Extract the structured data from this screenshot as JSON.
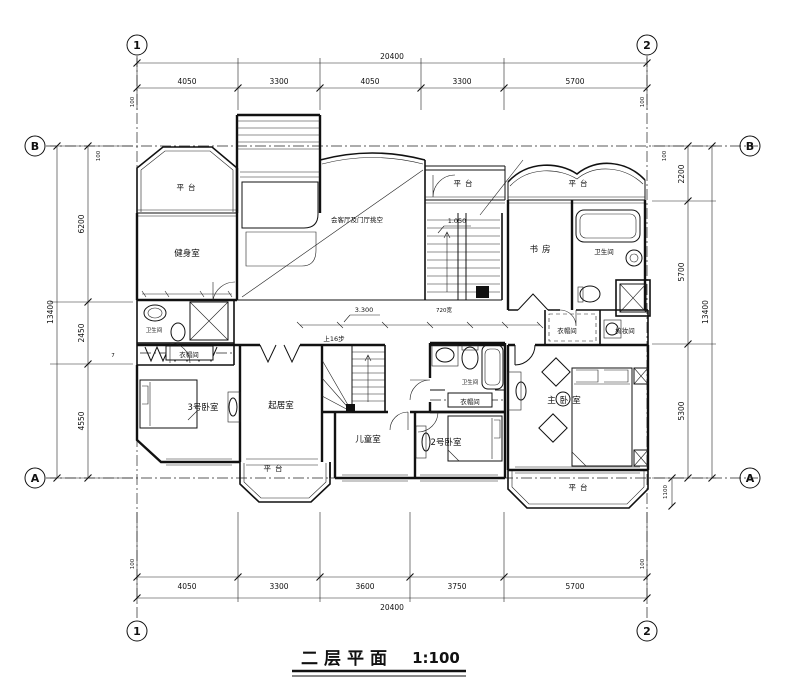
{
  "title": {
    "text": "二层平面",
    "scale": "1:100"
  },
  "axes": {
    "col_left": "1",
    "col_right": "2",
    "row_top": "B",
    "row_bottom": "A"
  },
  "dimensions": {
    "top": {
      "total": "20400",
      "seg1": "4050",
      "seg2": "3300",
      "seg3": "4050",
      "seg4": "3300",
      "seg5": "5700",
      "off_left": "100",
      "off_right": "100"
    },
    "bottom": {
      "total": "20400",
      "seg1": "4050",
      "seg2": "3300",
      "seg3": "3600",
      "seg4": "3750",
      "seg5": "5700",
      "off_left": "100",
      "off_right": "100"
    },
    "left": {
      "total": "13400",
      "seg1": "6200",
      "seg2": "2450",
      "seg3": "4550",
      "off_top": "100",
      "note": "7"
    },
    "right": {
      "total": "13400",
      "seg1": "2200",
      "seg2": "5700",
      "seg3": "5300",
      "off_top": "100",
      "below_a": "1100"
    }
  },
  "levels": {
    "stair_landing": "1.050",
    "second_floor": "3.300"
  },
  "notes": {
    "stair_width": "720宽",
    "stair_up": "上16步"
  },
  "rooms": {
    "terrace": "平台",
    "games": "健身室",
    "void": "会客厅及门厅挑空",
    "study": "书房",
    "bath": "卫生间",
    "closet": "衣帽间",
    "dressing": "梳妆间",
    "bedroom3": "3号卧室",
    "bedroom2": "2号卧室",
    "master": "主卧室",
    "family": "起居室",
    "kids": "儿童室"
  }
}
